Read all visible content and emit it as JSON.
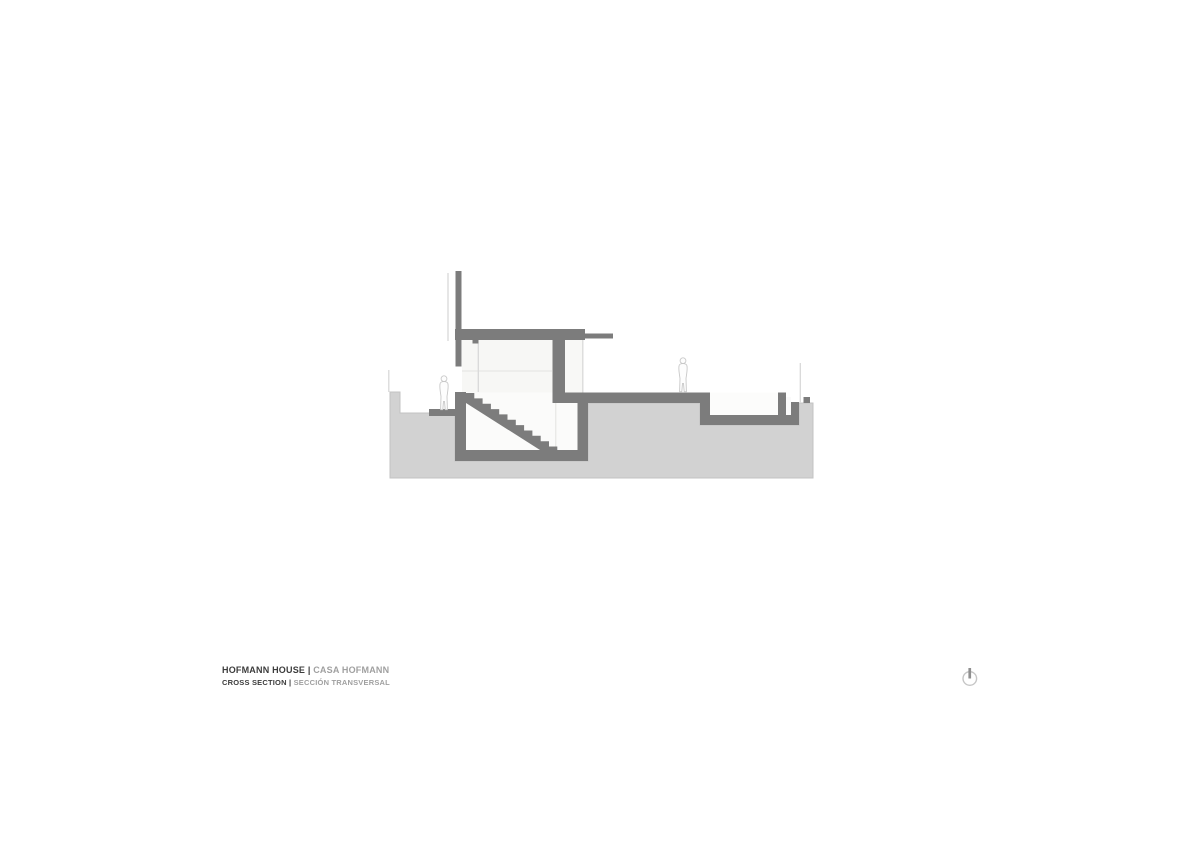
{
  "title_block": {
    "project_name_en": "HOFMANN HOUSE",
    "separator": "|",
    "project_name_es": "CASA HOFMANN",
    "drawing_name_en": "CROSS SECTION",
    "drawing_name_es": "SECCIÓN TRANSVERSAL"
  },
  "north_indicator": {
    "icon": "north-arrow-icon"
  },
  "drawing": {
    "type": "architectural-cross-section",
    "elements": [
      "ground-mass",
      "parapet-wall",
      "roof-slab",
      "canopy-slab",
      "stairwell-interior",
      "staircase",
      "basement-room",
      "ground-floor-slab",
      "sunken-basin",
      "drain-slot",
      "retaining-curb",
      "entry-threshold",
      "glass-lines",
      "guardrail-lines",
      "human-figure-left",
      "human-figure-right"
    ],
    "colors": {
      "background": "#ffffff",
      "ground_fill": "#d2d2d2",
      "ground_edge": "#c3c3c3",
      "structure_fill": "#7c7c7c",
      "interior_fill": "#f7f7f5",
      "light_line": "#d9d9d9",
      "figure_outline": "#c8c8c8",
      "title_primary": "#3c3c3c",
      "title_secondary": "#a0a0a0",
      "north_icon_ring": "#c6c6c6",
      "north_icon_tick": "#8f8f8f"
    }
  }
}
